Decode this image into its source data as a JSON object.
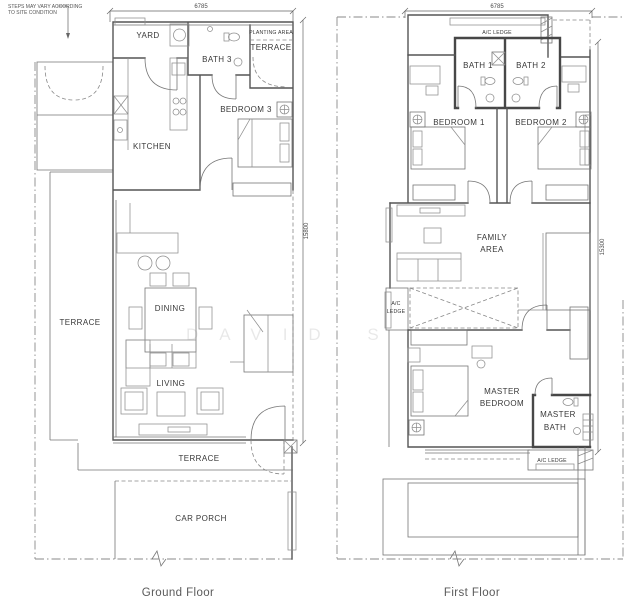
{
  "note": {
    "line1": "STEPS MAY VARY ACCORDING",
    "line2": "TO SITE CONDITION"
  },
  "watermark": "DAVID S",
  "ground_floor": {
    "title": "Ground Floor",
    "dims": {
      "top": "6785",
      "side": "15800"
    },
    "rooms": {
      "yard": "YARD",
      "bath3": "BATH 3",
      "planting_area": "PLANTING AREA",
      "terrace_top": "TERRACE",
      "bedroom3": "BEDROOM 3",
      "kitchen": "KITCHEN",
      "terrace_left": "TERRACE",
      "dining": "DINING",
      "living": "LIVING",
      "terrace_bottom": "TERRACE",
      "car_porch": "CAR PORCH"
    }
  },
  "first_floor": {
    "title": "First Floor",
    "dims": {
      "top": "6785",
      "side": "15300"
    },
    "rooms": {
      "ac_ledge_top": "A/C LEDGE",
      "bath1": "BATH 1",
      "bath2": "BATH 2",
      "bedroom1": "BEDROOM 1",
      "bedroom2": "BEDROOM 2",
      "family_line1": "FAMILY",
      "family_line2": "AREA",
      "ac_ledge_left_line1": "A/C",
      "ac_ledge_left_line2": "LEDGE",
      "master_line1": "MASTER",
      "master_line2": "BEDROOM",
      "master_bath_line1": "MASTER",
      "master_bath_line2": "BATH",
      "ac_ledge_bottom": "A/C LEDGE"
    }
  }
}
